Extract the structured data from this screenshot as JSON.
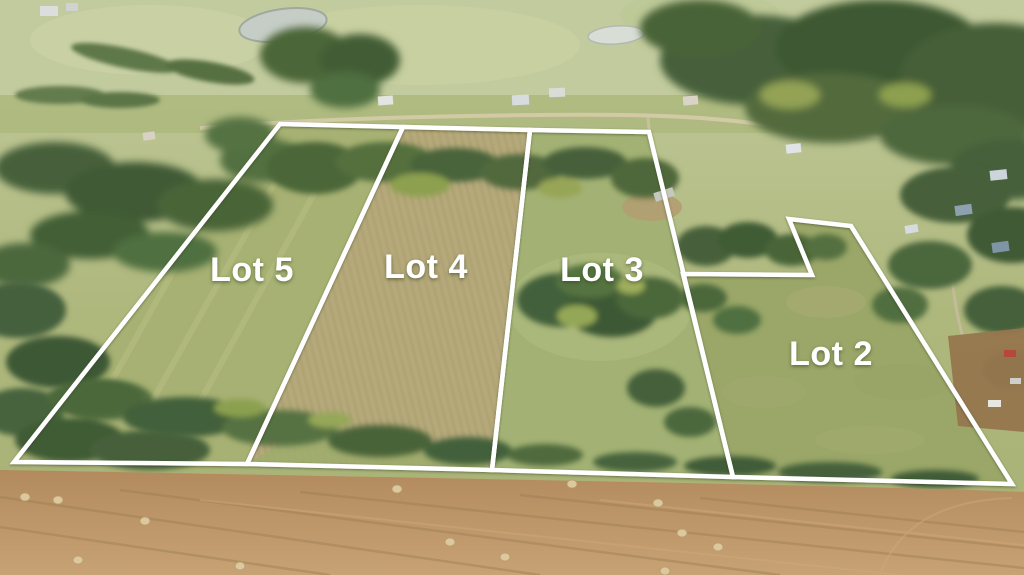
{
  "scene": {
    "lots": [
      {
        "id": "lot-5",
        "label": "Lot 5",
        "label_x": 252,
        "label_y": 270,
        "points": "280,124 403,127 247,464 14,462"
      },
      {
        "id": "lot-4",
        "label": "Lot 4",
        "label_x": 426,
        "label_y": 267,
        "points": "403,127 530,130 492,470 247,464"
      },
      {
        "id": "lot-3",
        "label": "Lot 3",
        "label_x": 602,
        "label_y": 270,
        "points": "530,130 649,132 733,477 492,470"
      },
      {
        "id": "lot-2",
        "label": "Lot 2",
        "label_x": 831,
        "label_y": 354,
        "points": "683,274 812,275 789,219 851,226 1012,484 733,477"
      }
    ],
    "style": {
      "boundary_color": "#ffffff",
      "boundary_width": 4.5,
      "label_color": "#ffffff",
      "label_font_size": 34
    }
  }
}
